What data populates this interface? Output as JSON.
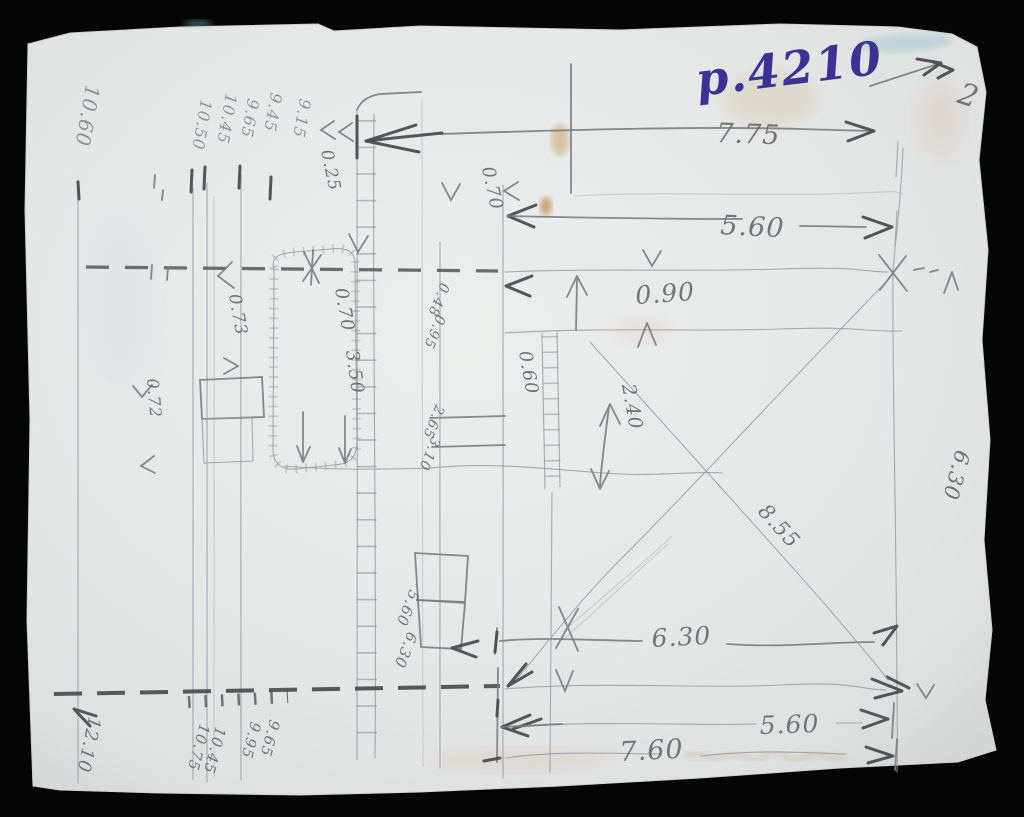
{
  "sheet": {
    "type": "hand-drawn field sketch",
    "ink_note": "p.4210",
    "orientation_mark": "2"
  },
  "labels": [
    {
      "name": "ink-page-number",
      "text": "p.4210",
      "x": 698,
      "y": 96,
      "rotate": -7,
      "size": 46,
      "cls": "ink"
    },
    {
      "name": "north-mark",
      "text": "2",
      "x": 956,
      "y": 102,
      "rotate": 18,
      "size": 30,
      "cls": "pencil"
    },
    {
      "name": "dim-left-top",
      "text": "10.60",
      "x": 86,
      "y": 84,
      "rotate": 100,
      "size": 20,
      "cls": "pencil-light"
    },
    {
      "name": "dim-top-cluster-1",
      "text": "10.50",
      "x": 201,
      "y": 99,
      "rotate": 100,
      "size": 16,
      "cls": "pencil-light"
    },
    {
      "name": "dim-top-cluster-2",
      "text": "10.45",
      "x": 226,
      "y": 93,
      "rotate": 100,
      "size": 16,
      "cls": "pencil-light"
    },
    {
      "name": "dim-top-cluster-3",
      "text": "9.65",
      "x": 248,
      "y": 98,
      "rotate": 100,
      "size": 16,
      "cls": "pencil-light"
    },
    {
      "name": "dim-top-cluster-4",
      "text": "9.45",
      "x": 271,
      "y": 92,
      "rotate": 100,
      "size": 16,
      "cls": "pencil-light"
    },
    {
      "name": "dim-top-cluster-5",
      "text": "9.15",
      "x": 300,
      "y": 98,
      "rotate": 100,
      "size": 16,
      "cls": "pencil-light"
    },
    {
      "name": "dim-0-25",
      "text": "0.25",
      "x": 321,
      "y": 151,
      "rotate": 78,
      "size": 17,
      "cls": "pencil"
    },
    {
      "name": "dim-0-70-top",
      "text": "0.70",
      "x": 482,
      "y": 168,
      "rotate": 78,
      "size": 18,
      "cls": "pencil"
    },
    {
      "name": "dim-7-75",
      "text": "7.75",
      "x": 716,
      "y": 142,
      "rotate": 2,
      "size": 27,
      "cls": "pencil"
    },
    {
      "name": "dim-5-60-upper",
      "text": "5.60",
      "x": 720,
      "y": 234,
      "rotate": 3,
      "size": 27,
      "cls": "pencil"
    },
    {
      "name": "dim-0-90",
      "text": "0.90",
      "x": 636,
      "y": 304,
      "rotate": -4,
      "size": 25,
      "cls": "pencil"
    },
    {
      "name": "dim-0-73",
      "text": "0.73",
      "x": 229,
      "y": 295,
      "rotate": 80,
      "size": 17,
      "cls": "pencil"
    },
    {
      "name": "dim-0-70-mid",
      "text": "0.70",
      "x": 335,
      "y": 289,
      "rotate": 80,
      "size": 18,
      "cls": "pencil"
    },
    {
      "name": "dim-3-50",
      "text": "3.50",
      "x": 346,
      "y": 351,
      "rotate": 82,
      "size": 18,
      "cls": "pencil"
    },
    {
      "name": "dim-0-72",
      "text": "0.72",
      "x": 147,
      "y": 379,
      "rotate": 85,
      "size": 16,
      "cls": "pencil"
    },
    {
      "name": "dim-0-48",
      "text": "0.48",
      "x": 441,
      "y": 282,
      "rotate": 112,
      "size": 14,
      "cls": "pencil"
    },
    {
      "name": "dim-0-95",
      "text": "0.95",
      "x": 437,
      "y": 314,
      "rotate": 112,
      "size": 14,
      "cls": "pencil"
    },
    {
      "name": "dim-2-65",
      "text": "2.65",
      "x": 436,
      "y": 404,
      "rotate": 112,
      "size": 14,
      "cls": "pencil"
    },
    {
      "name": "dim-3-10",
      "text": "3.10",
      "x": 432,
      "y": 436,
      "rotate": 112,
      "size": 14,
      "cls": "pencil"
    },
    {
      "name": "dim-0-60",
      "text": "0.60",
      "x": 519,
      "y": 352,
      "rotate": 80,
      "size": 18,
      "cls": "pencil"
    },
    {
      "name": "dim-2-40",
      "text": "2.40",
      "x": 622,
      "y": 385,
      "rotate": 80,
      "size": 19,
      "cls": "pencil"
    },
    {
      "name": "dim-8-55",
      "text": "8.55",
      "x": 757,
      "y": 512,
      "rotate": 48,
      "size": 21,
      "cls": "pencil"
    },
    {
      "name": "dim-6-30-right",
      "text": "6.30",
      "x": 956,
      "y": 449,
      "rotate": 105,
      "size": 21,
      "cls": "pencil"
    },
    {
      "name": "dim-5-60-small",
      "text": "5.60",
      "x": 410,
      "y": 589,
      "rotate": 112,
      "size": 15,
      "cls": "pencil"
    },
    {
      "name": "dim-6-30-small",
      "text": "6.30",
      "x": 408,
      "y": 631,
      "rotate": 112,
      "size": 15,
      "cls": "pencil"
    },
    {
      "name": "dim-6-30-bottom",
      "text": "6.30",
      "x": 652,
      "y": 647,
      "rotate": -3,
      "size": 25,
      "cls": "pencil"
    },
    {
      "name": "dim-5-60-bottom",
      "text": "5.60",
      "x": 760,
      "y": 734,
      "rotate": -2,
      "size": 25,
      "cls": "pencil"
    },
    {
      "name": "dim-7-60",
      "text": "7.60",
      "x": 620,
      "y": 761,
      "rotate": -3,
      "size": 27,
      "cls": "pencil"
    },
    {
      "name": "dim-12-10",
      "text": "12.10",
      "x": 89,
      "y": 716,
      "rotate": 102,
      "size": 18,
      "cls": "pencil"
    },
    {
      "name": "dim-bottom-cluster-1",
      "text": "10.75",
      "x": 200,
      "y": 723,
      "rotate": 105,
      "size": 15,
      "cls": "pencil"
    },
    {
      "name": "dim-bottom-cluster-2",
      "text": "10.45",
      "x": 216,
      "y": 726,
      "rotate": 105,
      "size": 15,
      "cls": "pencil"
    },
    {
      "name": "dim-bottom-cluster-3",
      "text": "9.95",
      "x": 251,
      "y": 721,
      "rotate": 105,
      "size": 15,
      "cls": "pencil"
    },
    {
      "name": "dim-bottom-cluster-4",
      "text": "9.65",
      "x": 270,
      "y": 719,
      "rotate": 105,
      "size": 15,
      "cls": "pencil"
    }
  ]
}
